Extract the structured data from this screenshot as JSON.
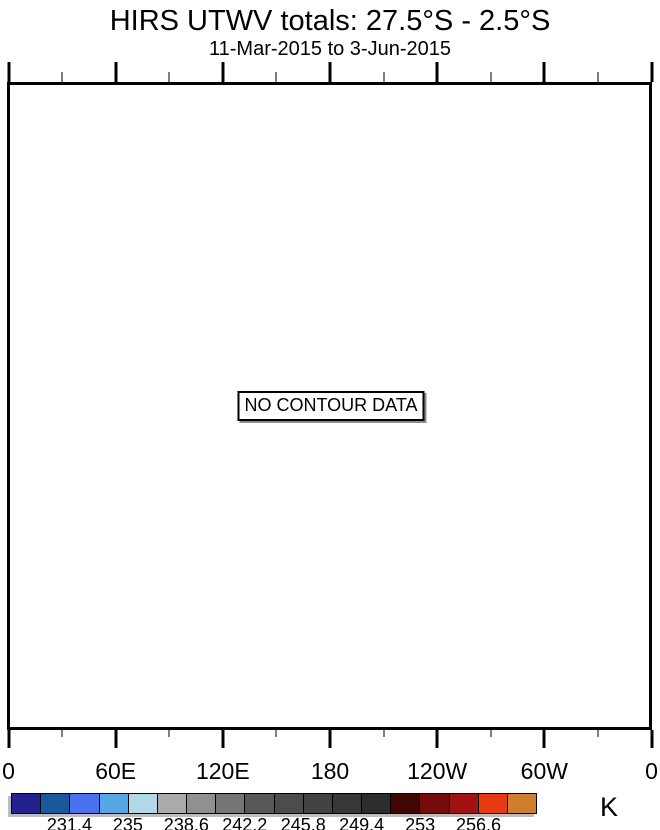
{
  "title": "HIRS UTWV totals: 27.5°S - 2.5°S",
  "subtitle": "11-Mar-2015 to 3-Jun-2015",
  "plot": {
    "no_data_label": "NO CONTOUR DATA"
  },
  "x_axis": {
    "tick_labels": [
      "0",
      "60E",
      "120E",
      "180",
      "120W",
      "60W",
      "0"
    ],
    "minor_ticks_between_majors": 1
  },
  "colorbar": {
    "unit_label": "K",
    "colors": [
      "#21218F",
      "#1A5A9C",
      "#4A72F0",
      "#55A8E6",
      "#B1D7E8",
      "#AAAAAA",
      "#909090",
      "#767676",
      "#585858",
      "#4C4C4C",
      "#424242",
      "#373737",
      "#2D2D2D",
      "#400606",
      "#740C0C",
      "#A31212",
      "#E83A10",
      "#D07E2E"
    ],
    "tick_labels": [
      "231.4",
      "235",
      "238.6",
      "242.2",
      "245.8",
      "249.4",
      "253",
      "256.6"
    ],
    "label_boundary_indices": [
      2,
      4,
      6,
      8,
      10,
      12,
      14,
      16
    ]
  },
  "style_colors": {
    "axis": "#000000",
    "minor_tick": "#7F7F7F",
    "shadow": "#BDBDBD"
  },
  "chart_data": {
    "type": "heatmap",
    "title": "HIRS UTWV totals: 27.5°S - 2.5°S",
    "subtitle": "11-Mar-2015 to 3-Jun-2015",
    "x_tick_labels": [
      "0",
      "60E",
      "120E",
      "180",
      "120W",
      "60W",
      "0"
    ],
    "x_range_degrees": [
      0,
      360
    ],
    "latitude_band": "27.5S to 2.5S",
    "values": [],
    "annotations": [
      "NO CONTOUR DATA"
    ],
    "legend_position": "bottom",
    "grid": false,
    "colorbar": {
      "unit": "K",
      "tick_labels": [
        "231.4",
        "235",
        "238.6",
        "242.2",
        "245.8",
        "249.4",
        "253",
        "256.6"
      ],
      "colors": [
        "#21218F",
        "#1A5A9C",
        "#4A72F0",
        "#55A8E6",
        "#B1D7E8",
        "#AAAAAA",
        "#909090",
        "#767676",
        "#585858",
        "#4C4C4C",
        "#424242",
        "#373737",
        "#2D2D2D",
        "#400606",
        "#740C0C",
        "#A31212",
        "#E83A10",
        "#D07E2E"
      ]
    }
  }
}
